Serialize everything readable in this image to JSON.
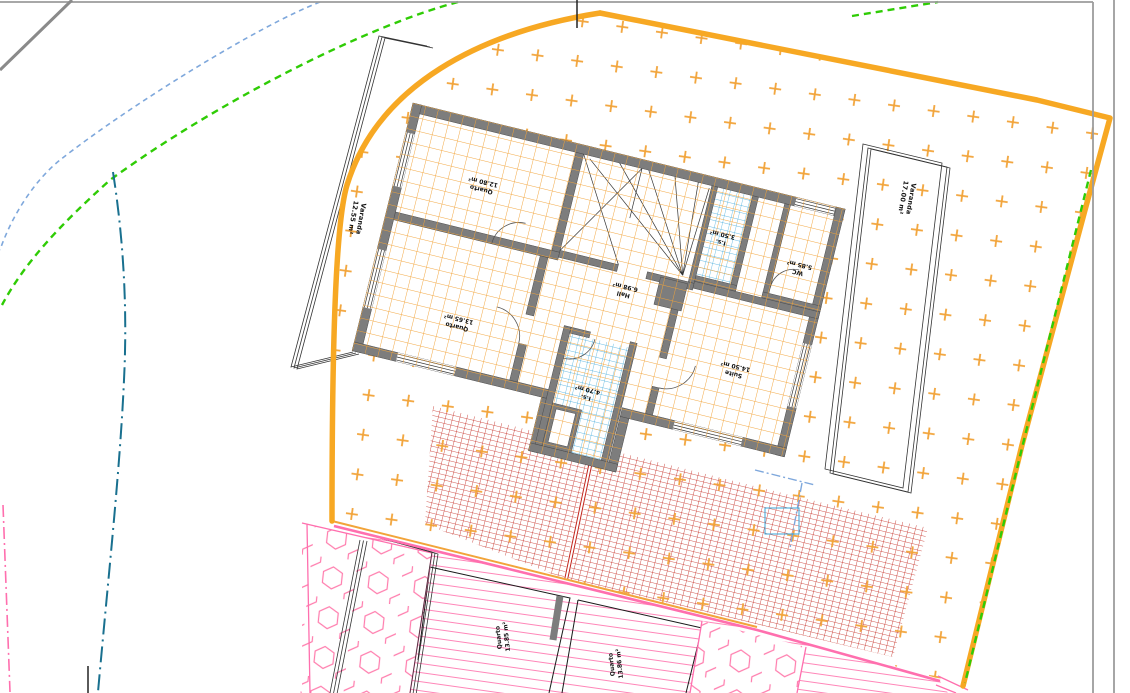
{
  "app": {
    "type": "architectural-site-plan",
    "description": "CAD drawing of a house upper floor over lot with hatched patios"
  },
  "colors": {
    "boundary": "#F7A823",
    "hatch": "#F2A43A",
    "wall": "#7D7D7D",
    "cyan": "#3AA6D9",
    "brick": "#C2251C",
    "pink": "#FF86B8",
    "pinkline": "#FF6FAE",
    "green": "#2FCC05",
    "blue": "#7FA8DC",
    "teal": "#19708F",
    "pagegray": "#9C9C9C",
    "ink": "#1A1A1A"
  },
  "rooms": {
    "varanda_left": {
      "name": "Varanda",
      "area": "12.55 m²"
    },
    "varanda_right": {
      "name": "Varanda",
      "area": "17.00 m²"
    },
    "quarto_top": {
      "name": "Quarto",
      "area": "12.80 m²"
    },
    "quarto_bottom": {
      "name": "Quarto",
      "area": "13.65 m²"
    },
    "hall": {
      "name": "Hall",
      "area": "6.98 m²"
    },
    "is_small": {
      "name": "I.s.",
      "area": "3.50 m²"
    },
    "wc": {
      "name": "WC",
      "area": "5.85 m²"
    },
    "suite": {
      "name": "Suite",
      "area": "14.50 m²"
    },
    "is_main": {
      "name": "I.s.",
      "area": "4.70 m²"
    },
    "quarto_lower_left": {
      "name": "Quarto",
      "area": "13.85 m²"
    },
    "quarto_lower_right": {
      "name": "Quarto",
      "area": "13.86 m²"
    }
  }
}
